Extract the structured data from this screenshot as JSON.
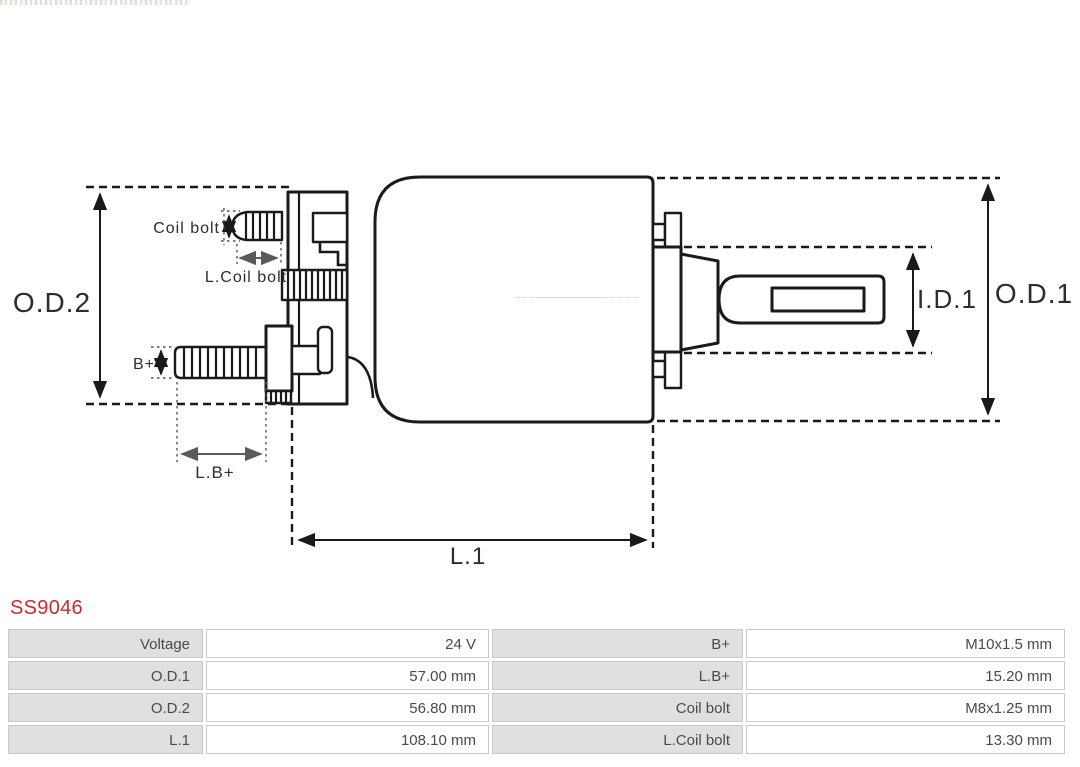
{
  "page": {
    "part_number": "SS9046"
  },
  "colors": {
    "accent-red": "#cc2b2b",
    "table-label-bg": "#e0e0e0",
    "table-border": "#c9c9c9",
    "table-text": "#4a4a4a",
    "line": "#1a1a1a",
    "gray-arrow": "#5a5a5a"
  },
  "diagram": {
    "labels": {
      "od2": "O.D.2",
      "od1": "O.D.1",
      "id1": "I.D.1",
      "l1": "L.1",
      "coil_bolt": "Coil bolt",
      "l_coil_bolt": "L.Coil bolt",
      "b_plus": "B+",
      "l_b_plus": "L.B+"
    }
  },
  "table": {
    "rows": [
      {
        "c0": "Voltage",
        "c1": "24 V",
        "c2": "B+",
        "c3": "M10x1.5 mm"
      },
      {
        "c0": "O.D.1",
        "c1": "57.00 mm",
        "c2": "L.B+",
        "c3": "15.20 mm"
      },
      {
        "c0": "O.D.2",
        "c1": "56.80 mm",
        "c2": "Coil bolt",
        "c3": "M8x1.25 mm"
      },
      {
        "c0": "L.1",
        "c1": "108.10 mm",
        "c2": "L.Coil bolt",
        "c3": "13.30 mm"
      }
    ]
  }
}
